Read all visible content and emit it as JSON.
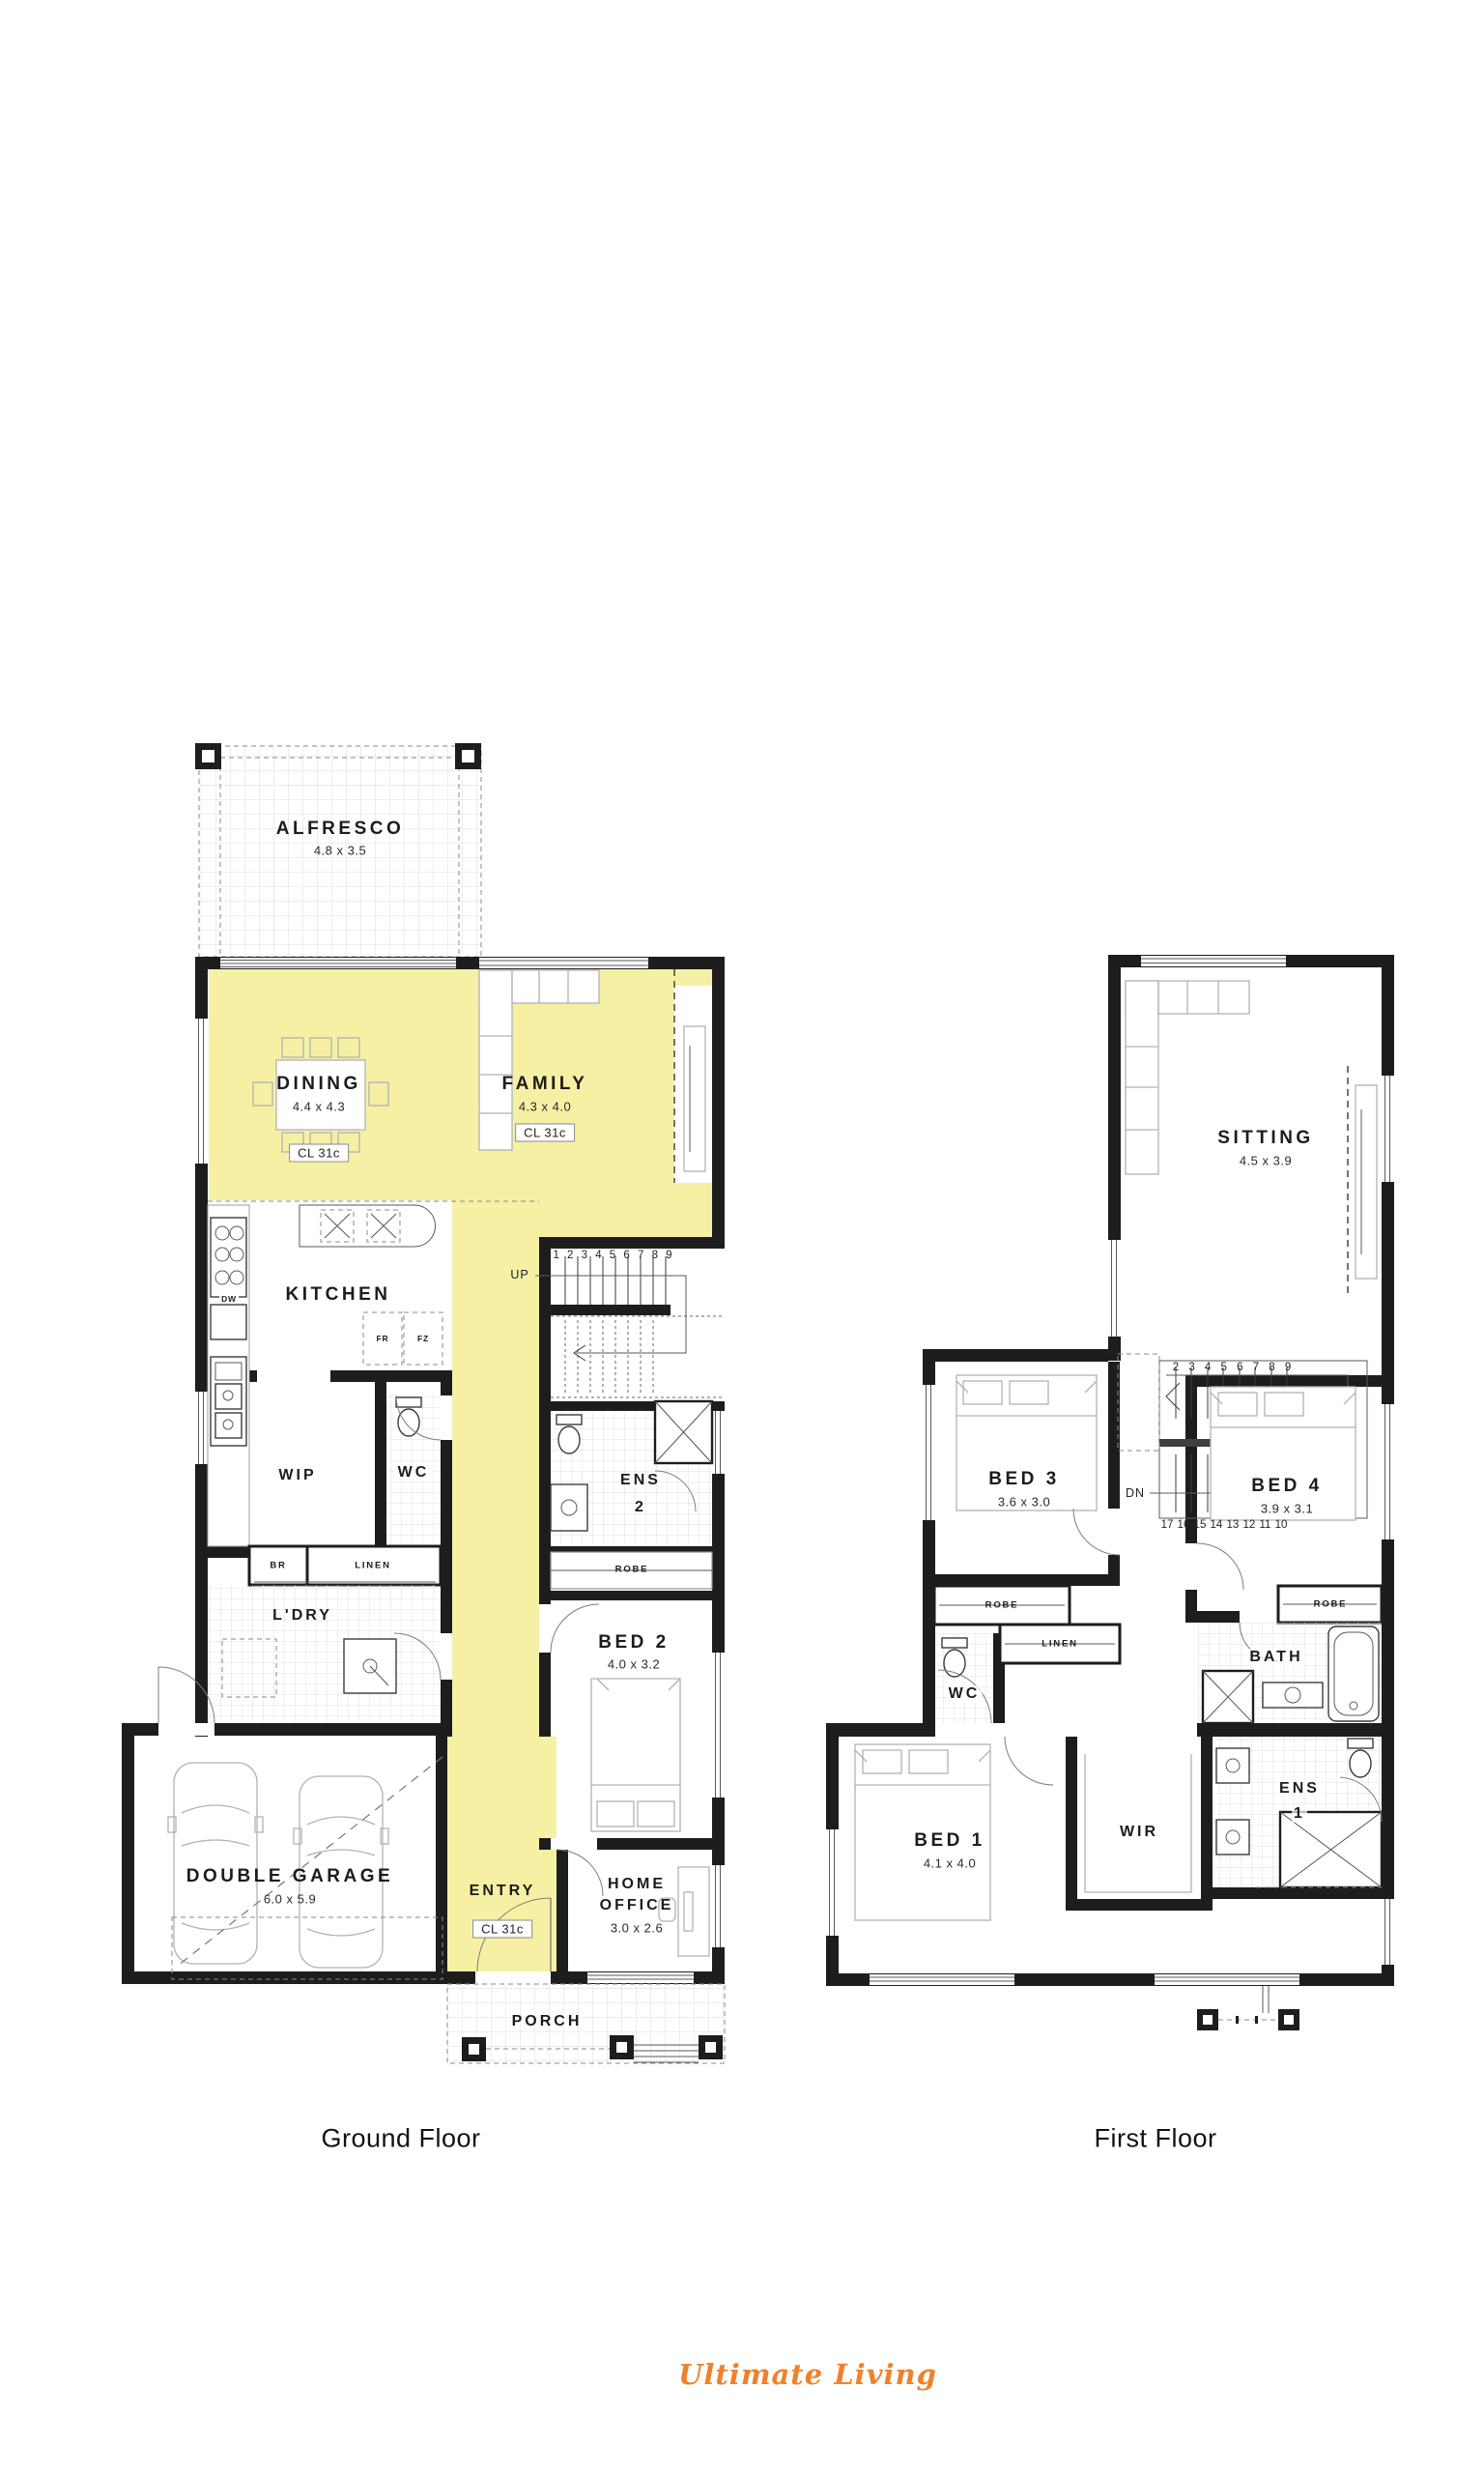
{
  "brand": {
    "logo": "Ultimate Living",
    "logo_color": "#F0812B"
  },
  "captions": {
    "ground": "Ground Floor",
    "first": "First Floor"
  },
  "colors": {
    "highlight": "#F6F0A4",
    "wall": "#1d1d1d"
  },
  "g": {
    "alfresco": "ALFRESCO",
    "alfresco_dims": "4.8 x 3.5",
    "dining": "DINING",
    "dining_dims": "4.4 x 4.3",
    "dining_cl": "CL 31c",
    "family": "FAMILY",
    "family_dims": "4.3 x 4.0",
    "family_cl": "CL 31c",
    "kitchen": "KITCHEN",
    "fr": "FR",
    "fz": "FZ",
    "dw": "DW",
    "wip": "WIP",
    "wc": "WC",
    "up": "UP",
    "stairs": [
      "1",
      "2",
      "3",
      "4",
      "5",
      "6",
      "7",
      "8",
      "9"
    ],
    "ens2": "ENS",
    "ens2_num": "2",
    "robe": "ROBE",
    "br": "BR",
    "linen": "LINEN",
    "ldry": "L'DRY",
    "bed2": "BED 2",
    "bed2_dims": "4.0 x 3.2",
    "garage": "DOUBLE GARAGE",
    "garage_dims": "6.0 x 5.9",
    "entry": "ENTRY",
    "entry_cl": "CL 31c",
    "office1": "HOME",
    "office2": "OFFICE",
    "office_dims": "3.0 x 2.6",
    "porch": "PORCH"
  },
  "f": {
    "sitting": "SITTING",
    "sitting_dims": "4.5 x 3.9",
    "stairs_top": [
      "2",
      "3",
      "4",
      "5",
      "6",
      "7",
      "8",
      "9"
    ],
    "stairs_bottom": [
      "17",
      "16",
      "15",
      "14",
      "13",
      "12",
      "11",
      "10"
    ],
    "dn": "DN",
    "bed3": "BED 3",
    "bed3_dims": "3.6 x 3.0",
    "bed4": "BED 4",
    "bed4_dims": "3.9 x 3.1",
    "robe3": "ROBE",
    "robe4": "ROBE",
    "linen": "LINEN",
    "wc": "WC",
    "bath": "BATH",
    "bed1": "BED 1",
    "bed1_dims": "4.1 x 4.0",
    "wir": "WIR",
    "ens1": "ENS",
    "ens1_num": "1"
  }
}
